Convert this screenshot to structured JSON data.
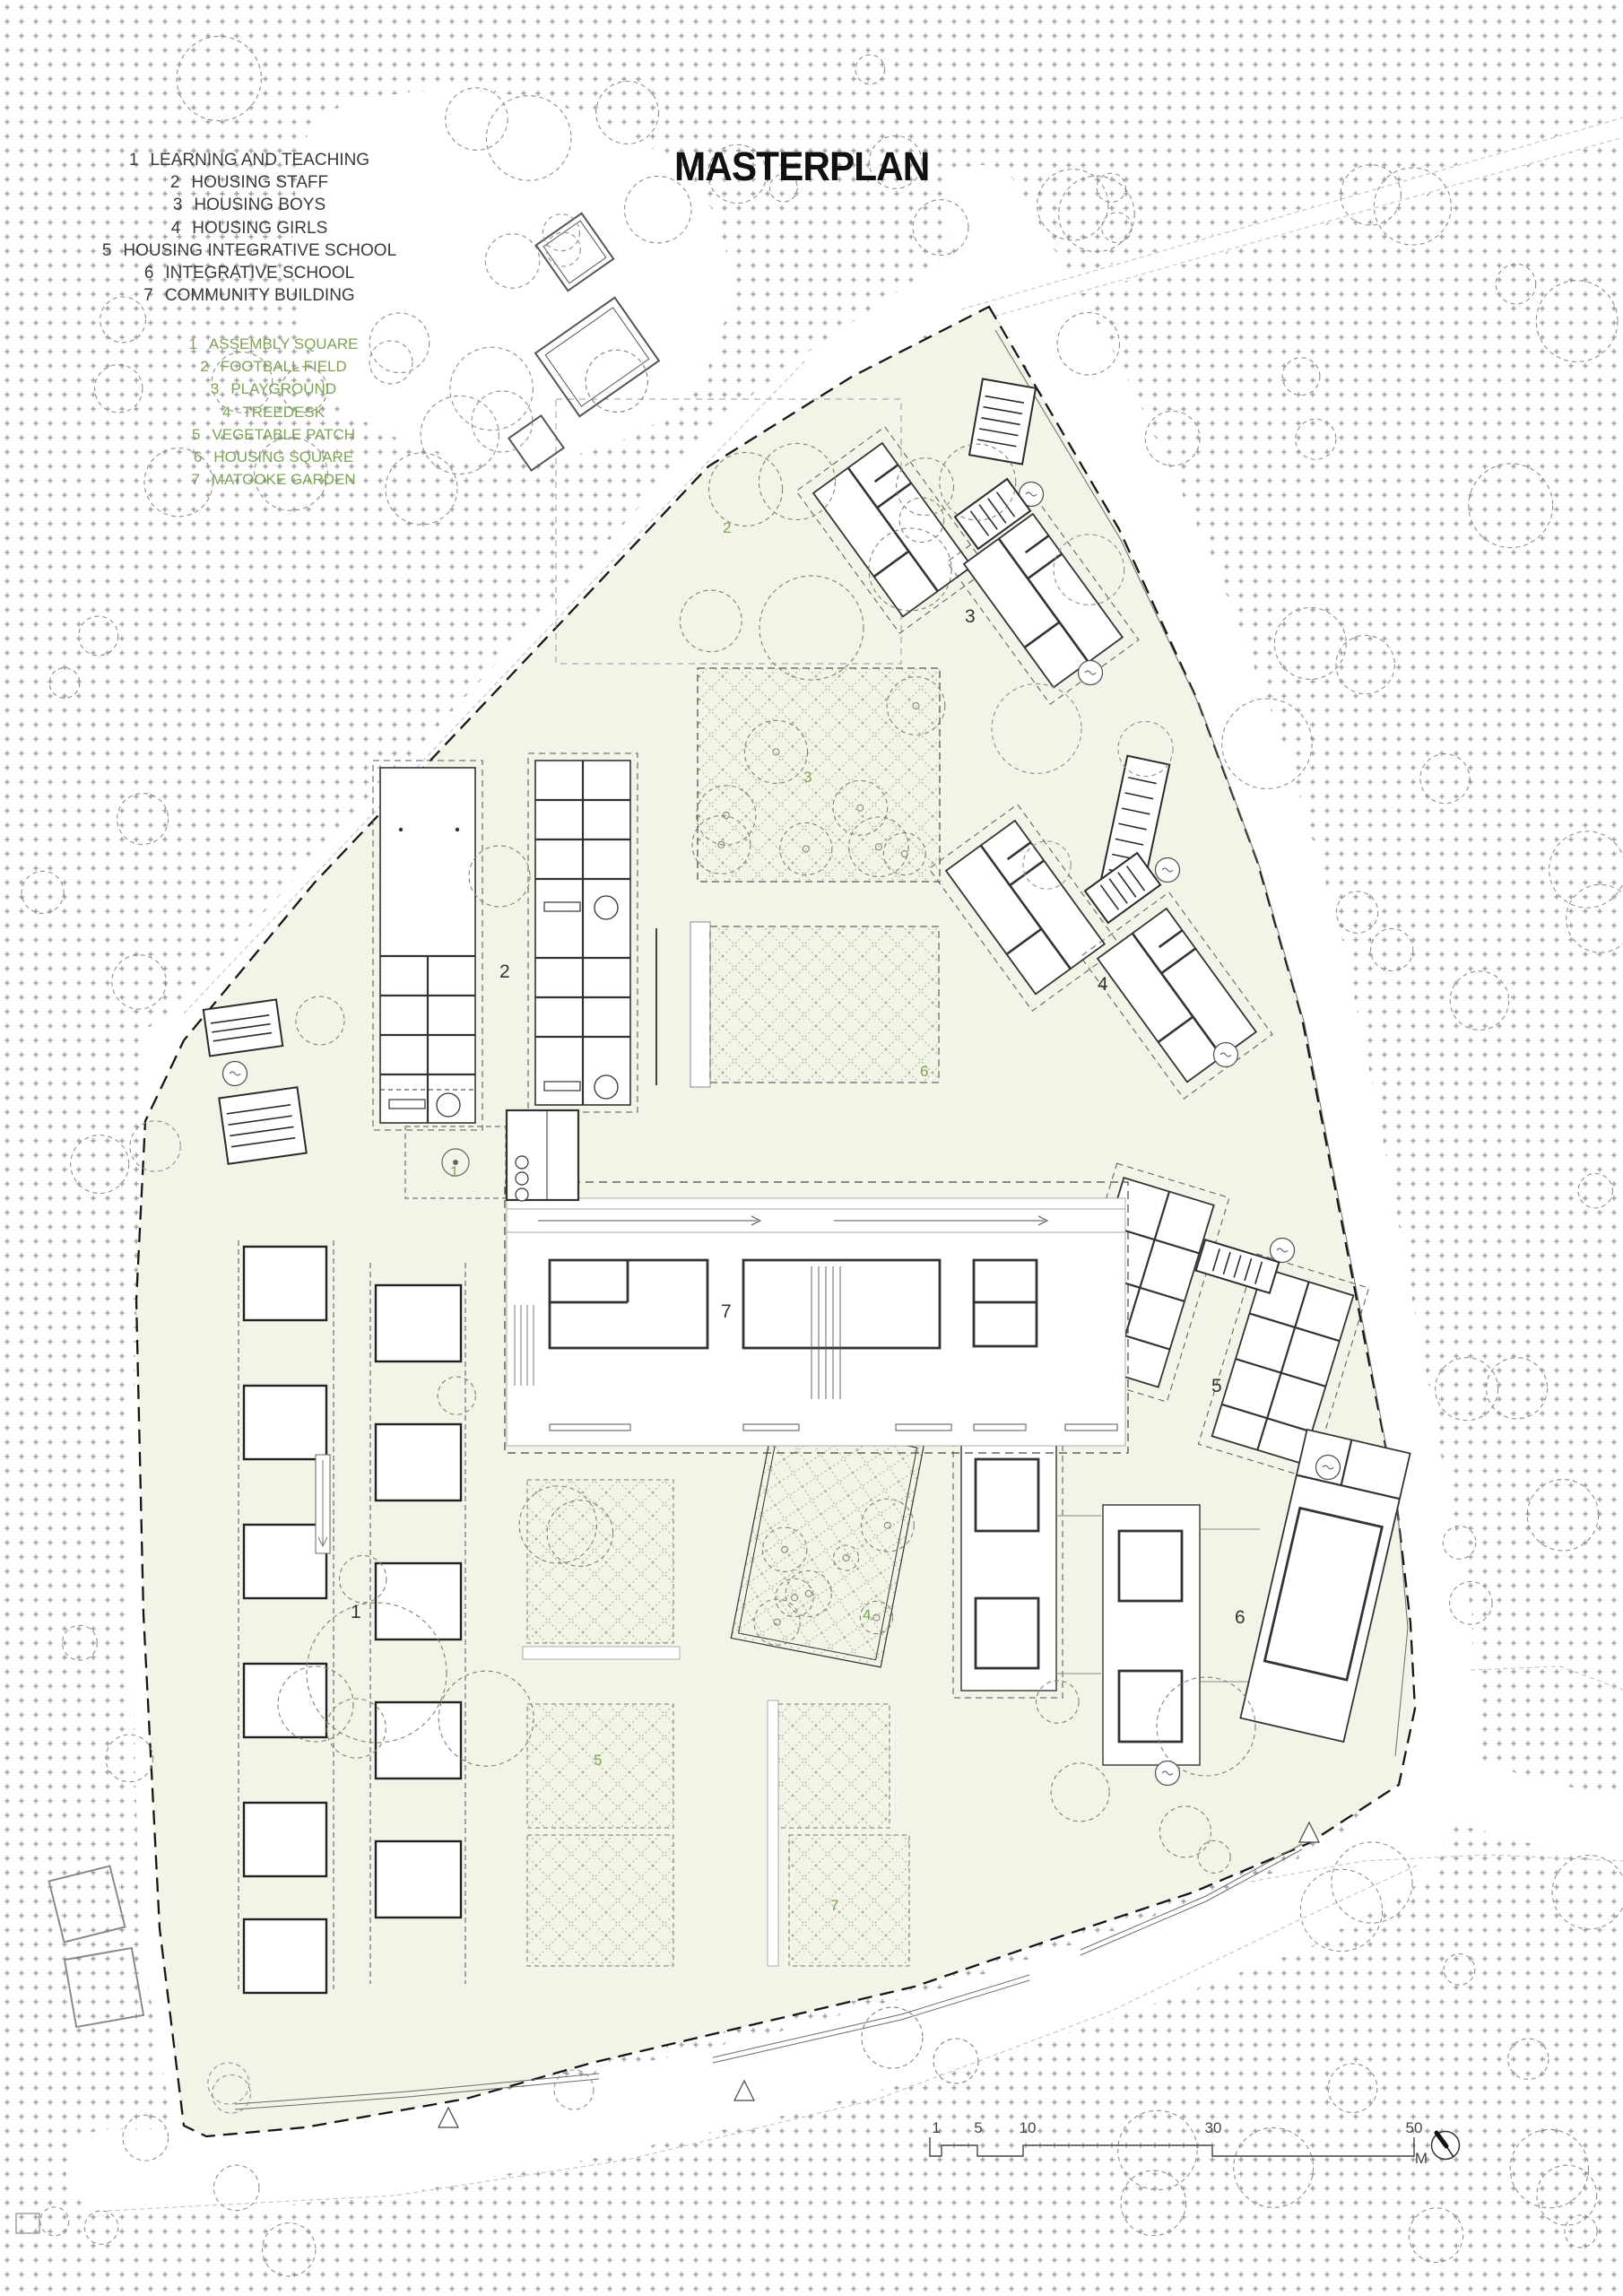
{
  "title": "MASTERPLAN",
  "legend_buildings": {
    "items": [
      {
        "num": "1",
        "label": "LEARNING AND TEACHING"
      },
      {
        "num": "2",
        "label": "HOUSING STAFF"
      },
      {
        "num": "3",
        "label": "HOUSING BOYS"
      },
      {
        "num": "4",
        "label": "HOUSING GIRLS"
      },
      {
        "num": "5",
        "label": "HOUSING INTEGRATIVE SCHOOL"
      },
      {
        "num": "6",
        "label": "INTEGRATIVE SCHOOL"
      },
      {
        "num": "7",
        "label": "COMMUNITY BUILDING"
      }
    ]
  },
  "legend_landscape": {
    "items": [
      {
        "num": "1",
        "label": "ASSEMBLY SQUARE"
      },
      {
        "num": "2",
        "label": "FOOTBALL FIELD"
      },
      {
        "num": "3",
        "label": "PLAYGROUND"
      },
      {
        "num": "4",
        "label": "TREEDESK"
      },
      {
        "num": "5",
        "label": "VEGETABLE PATCH"
      },
      {
        "num": "6",
        "label": "HOUSING SQUARE"
      },
      {
        "num": "7",
        "label": "MATOOKE GARDEN"
      }
    ]
  },
  "plan": {
    "building_labels": [
      "1",
      "2",
      "3",
      "4",
      "5",
      "6",
      "7"
    ],
    "landscape_labels": [
      "1",
      "2",
      "3",
      "4",
      "5",
      "6",
      "7"
    ]
  },
  "scale_bar": {
    "ticks": [
      "1",
      "5",
      "10",
      "30",
      "50"
    ],
    "unit": "M"
  },
  "colors": {
    "accent_green": "#7da356",
    "site_fill": "#f1f4e6",
    "ink": "#2e2e2e"
  }
}
